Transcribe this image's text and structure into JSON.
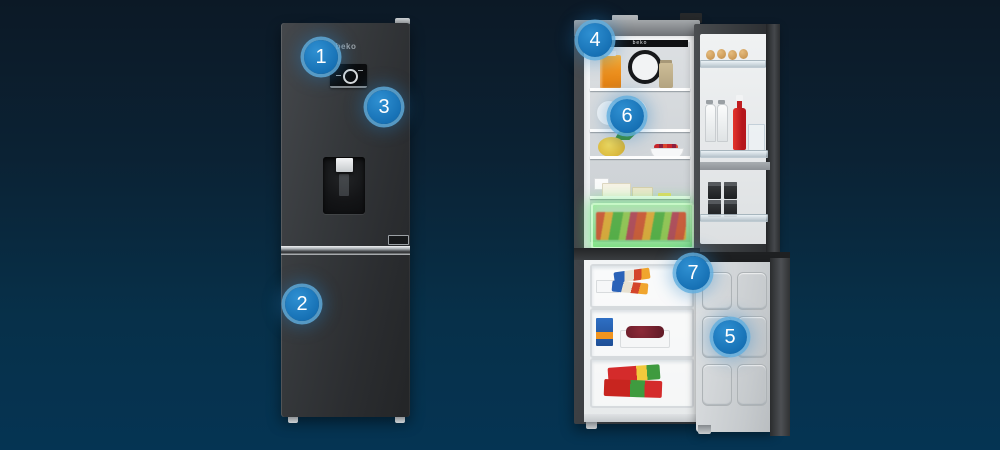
{
  "scene": {
    "title": "Beko combi refrigerator feature callouts",
    "background_top": "#0c1926",
    "background_bottom": "#053453",
    "accent_blue": "#1b79c0"
  },
  "closed_fridge": {
    "brand_label": "beko"
  },
  "open_fridge": {
    "interior_brand_label": "beko"
  },
  "badges": [
    {
      "number": "1"
    },
    {
      "number": "2"
    },
    {
      "number": "3"
    },
    {
      "number": "4"
    },
    {
      "number": "5"
    },
    {
      "number": "6"
    },
    {
      "number": "7"
    }
  ]
}
